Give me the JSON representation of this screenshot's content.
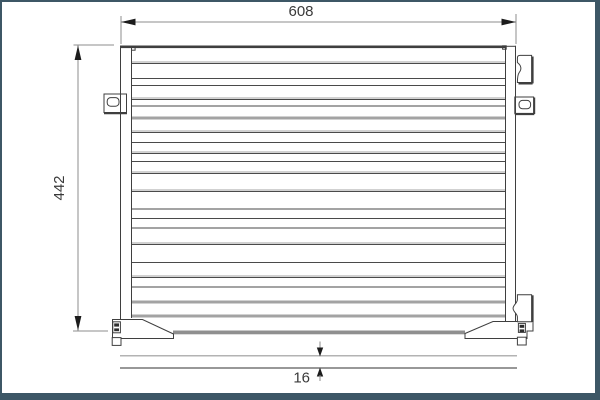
{
  "drawing": {
    "title": "condenser-technical-drawing",
    "dimension_width": {
      "label": "608"
    },
    "dimension_height": {
      "label": "442"
    },
    "dimension_depth": {
      "label": "16"
    },
    "colors": {
      "frame_border": "#3d5766",
      "background": "#ffffff",
      "line_dark": "#4a4a4a",
      "line_gray": "#a3a3a3",
      "header_dark": "#3f3f3f",
      "tube_gray": "#8f8f8f",
      "dim_line": "#8c8c8c",
      "arrow": "#1c1c1c",
      "text": "#3a3a3a",
      "side_view_top_line": "#9a9a9a",
      "side_view_bottom_line": "#5a5a5a"
    },
    "fins": [
      [
        63,
        "p"
      ],
      [
        78,
        "d"
      ],
      [
        85,
        "d"
      ],
      [
        99,
        "p"
      ],
      [
        105,
        "g"
      ],
      [
        117,
        "G"
      ],
      [
        132,
        "p"
      ],
      [
        142,
        "d"
      ],
      [
        153,
        "p"
      ],
      [
        161,
        "d"
      ],
      [
        173,
        "p"
      ],
      [
        191,
        "p"
      ],
      [
        208,
        "g"
      ],
      [
        218,
        "d"
      ],
      [
        227,
        "g"
      ],
      [
        244,
        "p"
      ],
      [
        262,
        "d"
      ],
      [
        277,
        "p"
      ],
      [
        286,
        "g"
      ],
      [
        301,
        "G"
      ],
      [
        315,
        "G"
      ]
    ]
  }
}
